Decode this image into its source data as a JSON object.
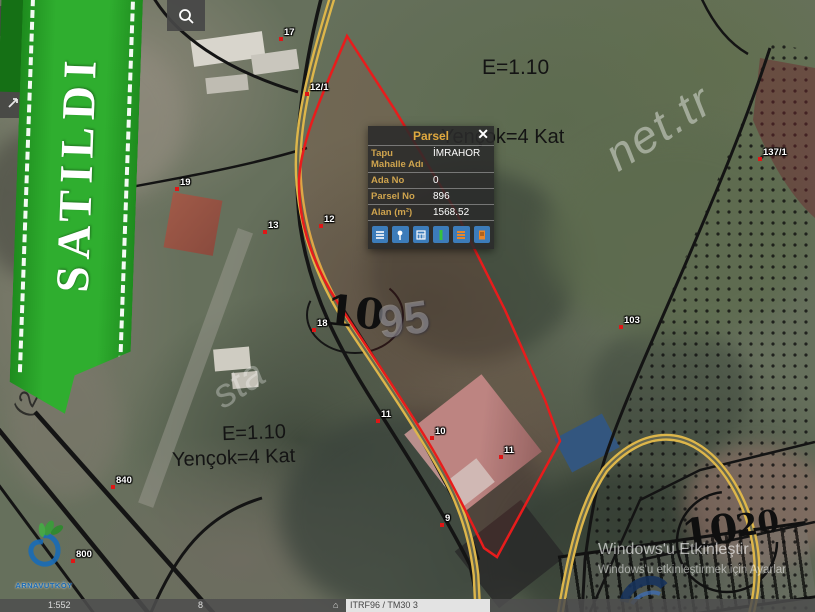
{
  "ribbon": {
    "label": "SATILDI"
  },
  "toolbar": {
    "zoom_in": "+",
    "zoom_out": "−"
  },
  "popup": {
    "title": "Parsel",
    "close": "✕",
    "fields": [
      {
        "label": "Tapu Mahalle Adı",
        "value": "İMRAHOR"
      },
      {
        "label": "Ada No",
        "value": "0"
      },
      {
        "label": "Parsel No",
        "value": "896"
      },
      {
        "label": "Alan (m²)",
        "value": "1568.52"
      }
    ]
  },
  "zoning": {
    "top_emsal": "E=1.10",
    "top_height": "Yençok=4 Kat",
    "bottom_emsal": "E=1.10",
    "bottom_height": "Yençok=4 Kat"
  },
  "markers": [
    {
      "text": "17"
    },
    {
      "text": "12/1"
    },
    {
      "text": "19"
    },
    {
      "text": "13"
    },
    {
      "text": "12"
    },
    {
      "text": "18"
    },
    {
      "text": "11"
    },
    {
      "text": "10"
    },
    {
      "text": "11"
    },
    {
      "text": "9"
    },
    {
      "text": "840"
    },
    {
      "text": "800"
    },
    {
      "text": "103"
    },
    {
      "text": "137/1"
    }
  ],
  "big_labels": {
    "parcel_left": "10",
    "ghost": "95",
    "parcel_right_a": "10",
    "parcel_right_b": "20"
  },
  "watermarks": {
    "site_fragment_right": "net.tr",
    "site_fragment_center": "sta",
    "survey_date": "(24.01.2019)",
    "windows_line1": "Windows'u Etkinleştir",
    "windows_line2": "Windows'u etkinleştirmek için Ayarlar"
  },
  "status_bar": {
    "scale": "1:552",
    "zoom_level": "8",
    "crs": "ITRF96 / TM30 3"
  },
  "logos": {
    "municipality_name": "ARNAVUTKÖY"
  }
}
